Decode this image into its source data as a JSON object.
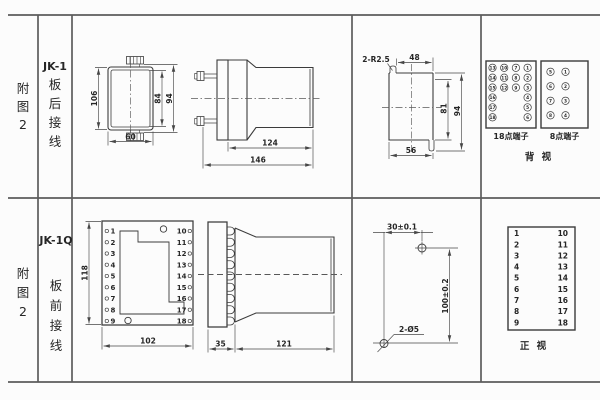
{
  "sheet": {
    "background": "#fcfcfc",
    "drawing_line_color": "#3b3b3b",
    "table_line_color": "#5c5c5c"
  },
  "row1": {
    "figure_label": "附图2",
    "figure_chars": [
      "附",
      "图",
      "2"
    ],
    "model": "JK-1",
    "wiring_label": "板后接线",
    "wiring_chars": [
      "板",
      "后",
      "接",
      "线"
    ],
    "rear_view": {
      "dims": {
        "height": "106",
        "inner_height": "84",
        "outer_height": "94",
        "width": "60"
      }
    },
    "side_view": {
      "dims": {
        "depth": "124",
        "total_depth": "146"
      }
    },
    "cutout_view": {
      "dims": {
        "corner_notches": "2-R2.5",
        "top_width": "48",
        "inner_height": "81",
        "height": "94",
        "width": "56"
      }
    },
    "terminals18": {
      "label": "18点端子",
      "columns": [
        [
          "13",
          "14",
          "15",
          "16",
          "17",
          "18"
        ],
        [
          "10",
          "11",
          "12"
        ],
        [
          "7",
          "8",
          "9"
        ],
        [
          "1",
          "2",
          "3",
          "4",
          "5",
          "6"
        ]
      ]
    },
    "terminals8": {
      "label": "8点端子",
      "columns": [
        [
          "5",
          "6",
          "7",
          "8"
        ],
        [
          "1",
          "2",
          "3",
          "4"
        ]
      ]
    },
    "view_label": "背 视"
  },
  "row2": {
    "figure_label": "附图2",
    "figure_chars": [
      "附",
      "图",
      "2"
    ],
    "model": "JK-1Q",
    "wiring_label": "板前接线",
    "wiring_chars": [
      "板",
      "前",
      "接",
      "线"
    ],
    "front_view": {
      "left_terminals": [
        "1",
        "2",
        "3",
        "4",
        "5",
        "6",
        "7",
        "8",
        "9"
      ],
      "right_terminals": [
        "10",
        "11",
        "12",
        "13",
        "14",
        "15",
        "16",
        "17",
        "18"
      ],
      "dims": {
        "height": "118",
        "width": "102"
      }
    },
    "side_view": {
      "dims": {
        "panel": "35",
        "body": "121"
      }
    },
    "drill_plan": {
      "dims": {
        "hole_spacing_x": "30±0.1",
        "hole_spacing_y": "100±0.2",
        "holes": "2-Ø5"
      }
    },
    "terminal_table": {
      "left": [
        "1",
        "2",
        "3",
        "4",
        "5",
        "6",
        "7",
        "8",
        "9"
      ],
      "right": [
        "10",
        "11",
        "12",
        "13",
        "14",
        "15",
        "16",
        "17",
        "18"
      ]
    },
    "view_label": "正 视"
  }
}
